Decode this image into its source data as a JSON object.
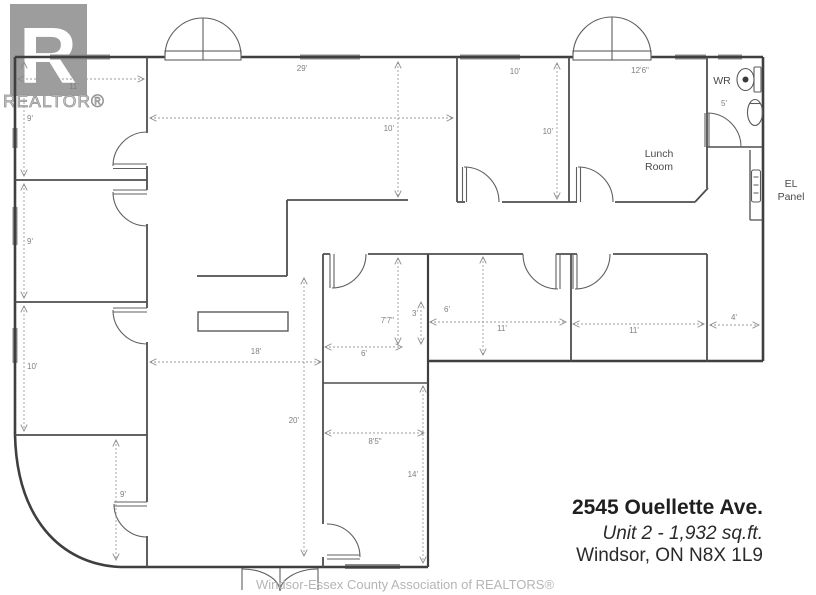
{
  "logo": {
    "letter": "R",
    "brand": "REALTOR®"
  },
  "plan": {
    "room_labels": {
      "wr": "WR",
      "lunch_line1": "Lunch",
      "lunch_line2": "Room",
      "el_line1": "EL",
      "el_line2": "Panel"
    },
    "dimensions": {
      "office1_width": "11'",
      "office1_depth": "9'",
      "office2_depth": "9'",
      "office3_depth": "10'",
      "office4_depth": "9'",
      "open_area_width": "29'",
      "open_area_depth": "10'",
      "mid_room_width": "10'",
      "mid_room_depth": "10'",
      "lunch_room_width": "12'6\"",
      "wr_width": "5'",
      "reception_width": "18'",
      "reception_depth": "20'",
      "inner_office_depth": "7'7\"",
      "inner_office_offset": "3'",
      "inner_office_width": "6'",
      "office5_offset": "6'",
      "office5_width": "11'",
      "office6_width": "11'",
      "hall_width": "4'",
      "bottom_room_width": "8'5\"",
      "bottom_room_depth": "14'"
    }
  },
  "address": {
    "line1": "2545 Ouellette Ave.",
    "line2": "Unit 2 - 1,932 sq.ft.",
    "line3": "Windsor, ON N8X 1L9"
  },
  "footer": {
    "text": "Windsor-Essex County Association of REALTORS®"
  }
}
